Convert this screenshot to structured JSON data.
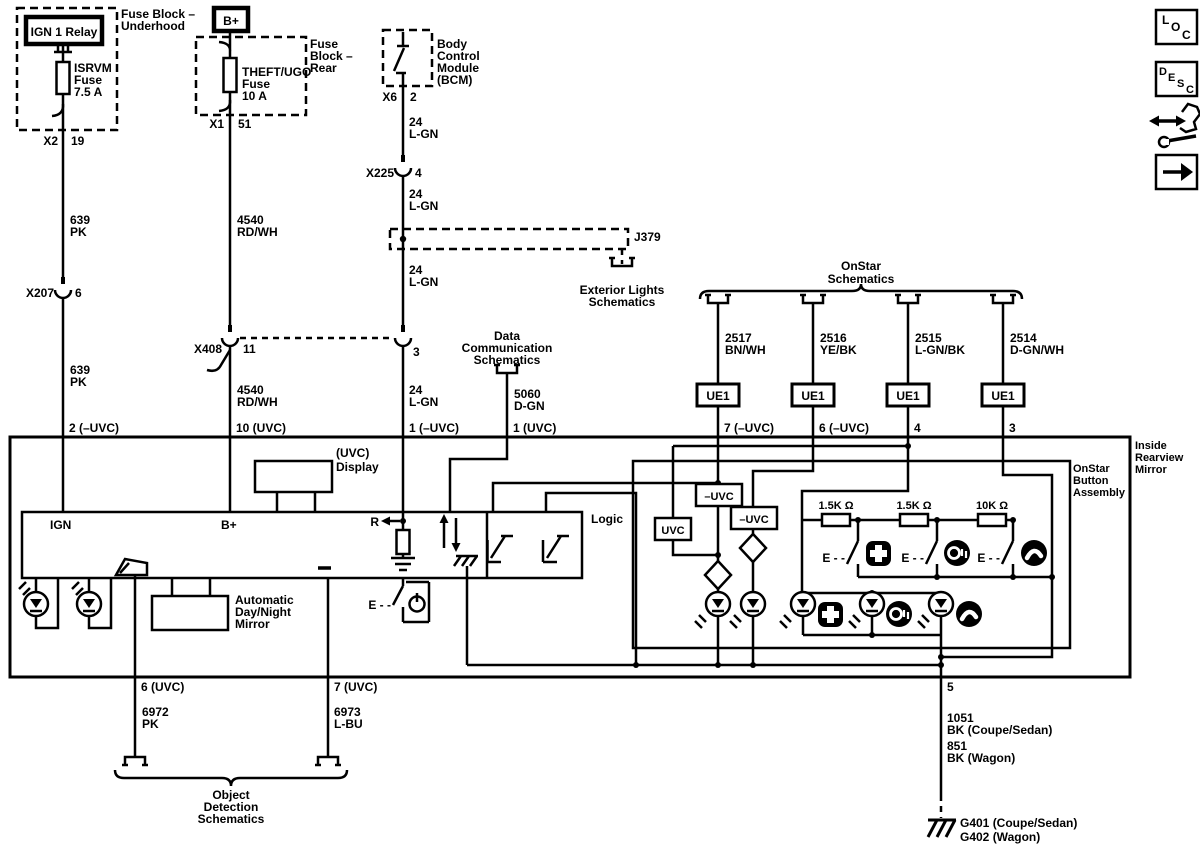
{
  "accent_color": "#000000",
  "background_color": "#ffffff",
  "sources": {
    "fuse_block_underhood": [
      "Fuse Block –",
      "Underhood"
    ],
    "ign_relay": "IGN 1 Relay",
    "isrvm_fuse": [
      "ISRVM",
      "Fuse",
      "7.5 A"
    ],
    "x2": "X2",
    "x2_pin": "19",
    "w639": [
      "639",
      "PK"
    ],
    "x207": "X207",
    "x207_pin": "6",
    "pin_2": "2 (–UVC)",
    "bplus": "B+",
    "fuse_block_rear": [
      "Fuse",
      "Block –",
      "Rear"
    ],
    "theft_fuse": [
      "THEFT/UGO",
      "Fuse",
      "10 A"
    ],
    "x1": "X1",
    "x1_pin": "51",
    "w4540": [
      "4540",
      "RD/WH"
    ],
    "x408": "X408",
    "x408_pin": "11",
    "pin_10": "10 (UVC)",
    "bcm": [
      "Body",
      "Control",
      "Module",
      "(BCM)"
    ],
    "x6": "X6",
    "x6_pin": "2",
    "w24": [
      "24",
      "L-GN"
    ],
    "x225": "X225",
    "x225_pin": "4",
    "x408b_pin": "3",
    "pin_1m": "1 (–UVC)",
    "j379": "J379",
    "exterior_lights": [
      "Exterior Lights",
      "Schematics"
    ],
    "data_comm": [
      "Data",
      "Communication",
      "Schematics"
    ],
    "w5060": [
      "5060",
      "D-GN"
    ],
    "pin_1p": "1 (UVC)"
  },
  "onstar": {
    "title": [
      "OnStar",
      "Schematics"
    ],
    "wires": [
      {
        "num": "2517",
        "color": "BN/WH",
        "conn": "UE1",
        "pin": "7 (–UVC)"
      },
      {
        "num": "2516",
        "color": "YE/BK",
        "conn": "UE1",
        "pin": "6 (–UVC)"
      },
      {
        "num": "2515",
        "color": "L-GN/BK",
        "conn": "UE1",
        "pin": "4"
      },
      {
        "num": "2514",
        "color": "D-GN/WH",
        "conn": "UE1",
        "pin": "3"
      }
    ]
  },
  "mirror": {
    "title": [
      "Inside",
      "Rearview",
      "Mirror"
    ],
    "display": [
      "(UVC)",
      "Display"
    ],
    "ign": "IGN",
    "bplus": "B+",
    "r": "R",
    "minus": "–",
    "logic": "Logic",
    "auto_mirror": [
      "Automatic",
      "Day/Night",
      "Mirror"
    ],
    "power_switch_prefix": "E - -"
  },
  "assembly": {
    "title": [
      "OnStar",
      "Button",
      "Assembly"
    ],
    "uvc": "UVC",
    "neg_uvc": "–UVC",
    "resistors": [
      "1.5K Ω",
      "1.5K Ω",
      "10K Ω"
    ],
    "switch_prefix": "E - -",
    "icons": [
      "emergency-cross",
      "onstar-logo",
      "phone-handset"
    ]
  },
  "bottom": {
    "pin_6": "6 (UVC)",
    "pin_7": "7 (UVC)",
    "pin_5": "5",
    "w6972": [
      "6972",
      "PK"
    ],
    "w6973": [
      "6973",
      "L-BU"
    ],
    "object_detection": [
      "Object",
      "Detection",
      "Schematics"
    ],
    "w1051": [
      "1051",
      "BK (Coupe/Sedan)"
    ],
    "w851": [
      "851",
      "BK (Wagon)"
    ],
    "g401": "G401 (Coupe/Sedan)",
    "g402": "G402 (Wagon)"
  },
  "toolbar": {
    "loc": [
      "L",
      "O",
      "C"
    ],
    "desc": [
      "D",
      "E",
      "S",
      "C"
    ]
  }
}
